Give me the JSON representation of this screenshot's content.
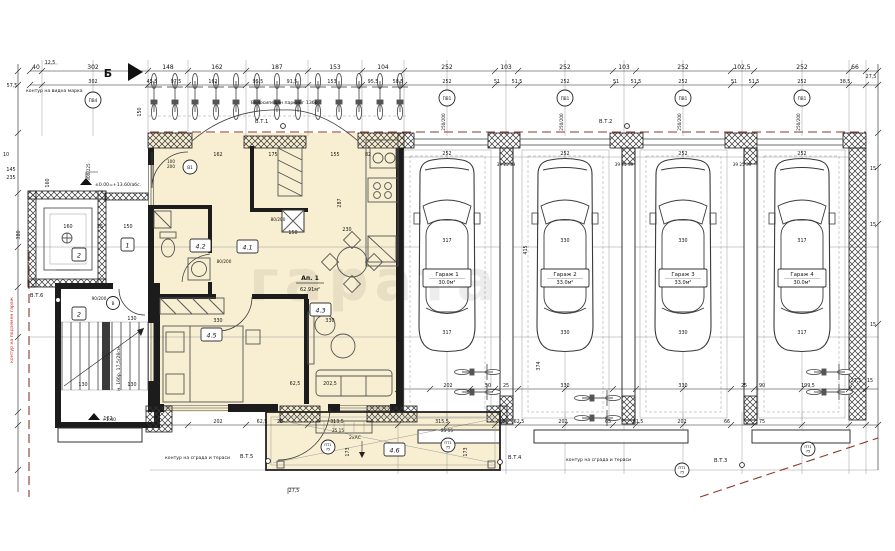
{
  "plan": {
    "axis_b": "Б",
    "levels": {
      "main": "±0.00=+13.60/абс.",
      "stair": "+1.40"
    },
    "notes": {
      "bikes": "Велосипеден паркинг 13бр.",
      "contour_top": "контур на видна марка",
      "contour_bl": "контур на сграда и тераси",
      "contour_br": "контур на сграда и тераси",
      "red_side": "контур на подземен гараж",
      "stair_note": "н. 16бр. 17,5/28см.",
      "ac": "2хАС",
      "watermark": "гарата"
    },
    "apartment": {
      "name": "Ап. 1",
      "area": "62.91м²"
    },
    "rooms": {
      "r41": "4.1",
      "r42": "4.2",
      "r43": "4.3",
      "r45": "4.5",
      "r46": "4.6",
      "lobby": "1",
      "stair_no": "2",
      "elev_no": "2"
    },
    "garages": [
      {
        "name": "Гараж 1",
        "area": "30.0м²"
      },
      {
        "name": "Гараж 2",
        "area": "33.0м²"
      },
      {
        "name": "Гараж 3",
        "area": "33.0м²"
      },
      {
        "name": "Гараж 4",
        "area": "30.0м²"
      }
    ],
    "survey": {
      "p1": "В.Т.1",
      "p2": "В.Т.2",
      "p3": "В.Т.3",
      "p4": "В.Т.4",
      "p5": "В.Т.5",
      "p6": "В.Т.6"
    },
    "markers": {
      "garage_win": "ПВ1",
      "garage_win_size": "250/200",
      "entry_win": "ПВ4",
      "entry_win_size": "300/225",
      "terr": "ПТ1",
      "terr_size": "75",
      "door_a": "В1",
      "door_a_w": "100",
      "door_a_h": "200",
      "door_b": "В",
      "door_b_size": "90/200",
      "door_c_size": "80/200",
      "wall_trio": "39 25 39"
    },
    "dims": {
      "top1": [
        "12,5",
        "40",
        "302",
        "148",
        "162",
        "187",
        "153",
        "104",
        "252",
        "103",
        "252",
        "103",
        "252",
        "102,5",
        "252",
        "66",
        "27,5"
      ],
      "top2": [
        "302",
        "45,5",
        "97,5",
        "162",
        "95,5",
        "91,5",
        "153",
        "95,5",
        "58,5",
        "252",
        "51",
        "51,5",
        "252",
        "51",
        "51,5",
        "252",
        "51",
        "51,5",
        "252",
        "38,5"
      ],
      "left": [
        "57,5",
        "380",
        "10",
        "145",
        "235",
        "160",
        "150"
      ],
      "right": [
        "15",
        "15",
        "15"
      ],
      "inner": [
        "162",
        "175",
        "155",
        "82",
        "230",
        "287",
        "150",
        "330",
        "330",
        "202,5",
        "62,5",
        "113",
        "130",
        "130",
        "130",
        "162",
        "160",
        "25",
        "150"
      ],
      "gar": [
        "252",
        "252",
        "252",
        "252",
        "317",
        "330",
        "330",
        "317",
        "317",
        "330",
        "330",
        "317",
        "415",
        "374"
      ],
      "bottom1": [
        "202",
        "50",
        "25",
        "330",
        "330",
        "25",
        "90",
        "199,5",
        "27,5",
        "15"
      ],
      "bottom2": [
        "202",
        "62,5",
        "25",
        "313,5",
        "315,5",
        "25",
        "62,5",
        "202",
        "65",
        "61,5",
        "202",
        "66",
        "75"
      ],
      "extra": [
        "27,5",
        "173",
        "173",
        "25 15",
        "25 15"
      ]
    }
  }
}
